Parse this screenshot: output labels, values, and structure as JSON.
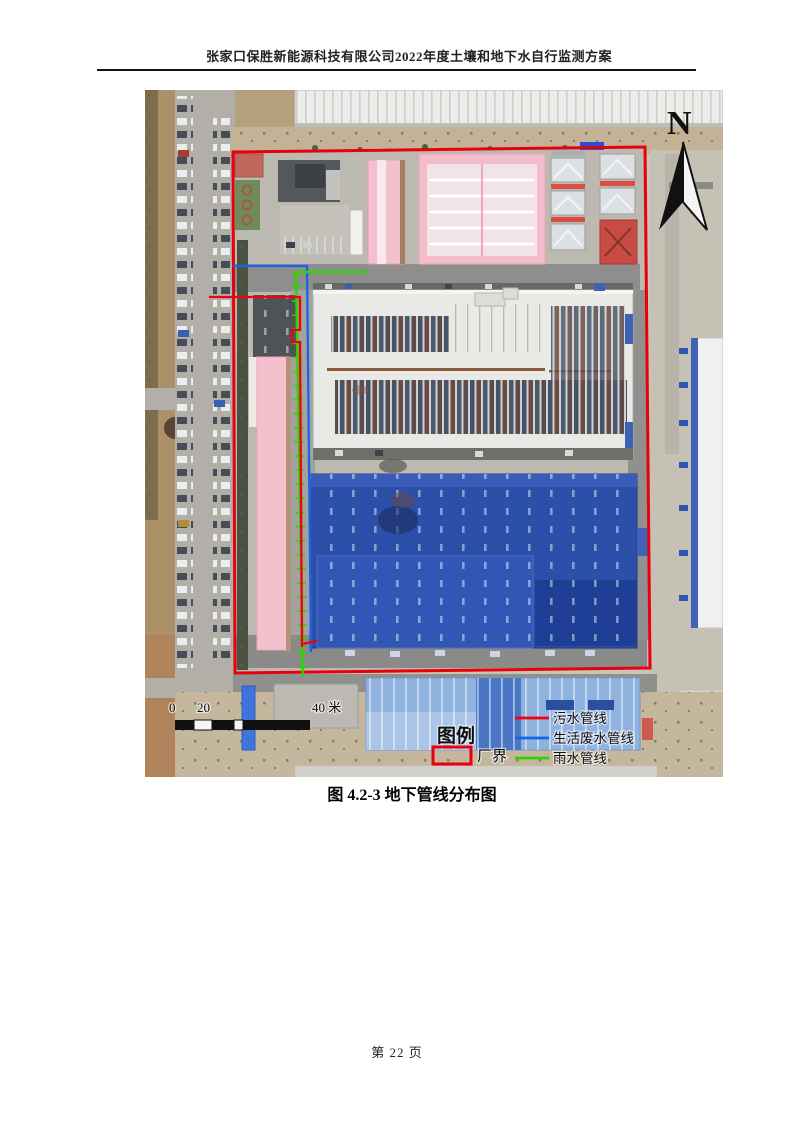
{
  "page": {
    "header_title": "张家口保胜新能源科技有限公司2022年度土壤和地下水自行监测方案",
    "figure_caption": "图 4.2-3 地下管线分布图",
    "page_number": "第 22 页"
  },
  "map": {
    "north_label": "N",
    "boundary_color": "#e8000d",
    "scale_bar": {
      "labels": [
        "0",
        "20",
        "40 米"
      ]
    },
    "legend": {
      "title": "图例",
      "boundary": {
        "label": "厂界",
        "color": "#e8000d"
      },
      "items": [
        {
          "label": "污水管线",
          "color": "#f2000c"
        },
        {
          "label": "生活废水管线",
          "color": "#1565e8"
        },
        {
          "label": "雨水管线",
          "color": "#2fd400"
        }
      ]
    }
  }
}
